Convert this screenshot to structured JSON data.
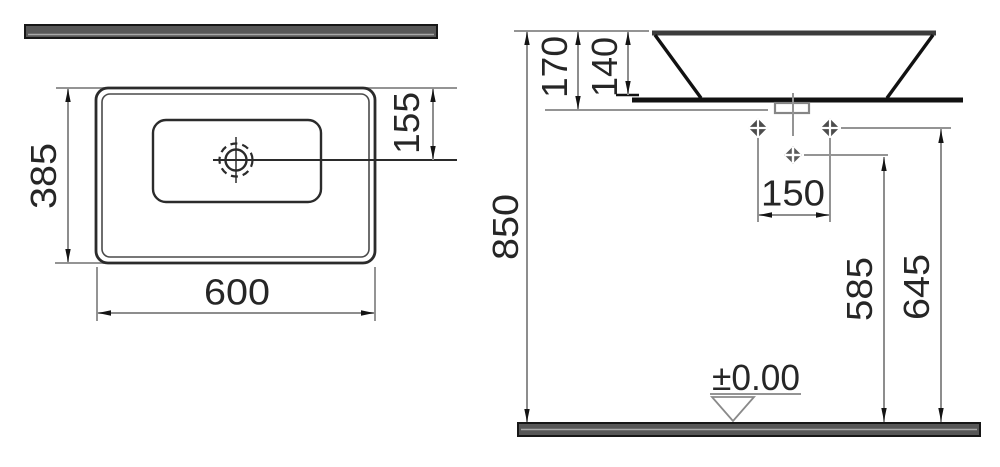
{
  "plan_view": {
    "depth_mm": "385",
    "width_mm": "600",
    "tap_center_offset_mm": "155"
  },
  "side_view": {
    "rim_height_from_floor_mm": "850",
    "total_height_mm": "170",
    "bowl_body_height_mm": "140",
    "hole_spacing_mm": "150",
    "mid_hole_from_floor_mm": "585",
    "upper_holes_from_floor_mm": "645",
    "floor_level": "±0.00"
  },
  "colors": {
    "object_line": "#1f1f1f",
    "secondary_line": "#4a4a4a",
    "dimension_line": "#949494",
    "strip_fill": "#575757",
    "text": "#262626",
    "background": "#ffffff"
  }
}
